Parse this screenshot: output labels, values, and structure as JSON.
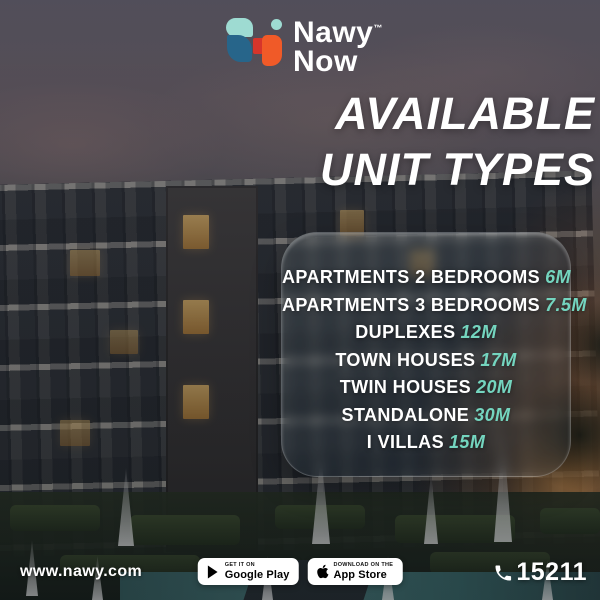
{
  "logo": {
    "brand_top": "Nawy",
    "trademark": "™",
    "brand_bottom": "Now"
  },
  "headline": {
    "line1": "AVAILABLE",
    "line2": "UNIT TYPES"
  },
  "units": {
    "items": [
      {
        "label": "APARTMENTS 2 BEDROOMS",
        "price": "6M"
      },
      {
        "label": "APARTMENTS 3 BEDROOMS",
        "price": "7.5M"
      },
      {
        "label": "DUPLEXES",
        "price": "12M"
      },
      {
        "label": "TOWN HOUSES",
        "price": "17M"
      },
      {
        "label": "TWIN HOUSES",
        "price": "20M"
      },
      {
        "label": "STANDALONE",
        "price": "30M"
      },
      {
        "label": "I VILLAS",
        "price": "15M"
      }
    ]
  },
  "footer": {
    "website": "www.nawy.com",
    "google_play": {
      "tagline": "GET IT ON",
      "store": "Google Play"
    },
    "app_store": {
      "tagline": "Download on the",
      "store": "App Store"
    },
    "phone": "15211"
  },
  "icons": {
    "phone": "phone-receiver",
    "google_play": "play-triangle",
    "app_store": "apple-logo"
  },
  "colors": {
    "price_accent": "#74d5bf",
    "logo_mint": "#9edbd2",
    "logo_blue": "#27658a",
    "logo_red": "#d6352b",
    "logo_orange": "#f05a28",
    "text": "#ffffff"
  }
}
